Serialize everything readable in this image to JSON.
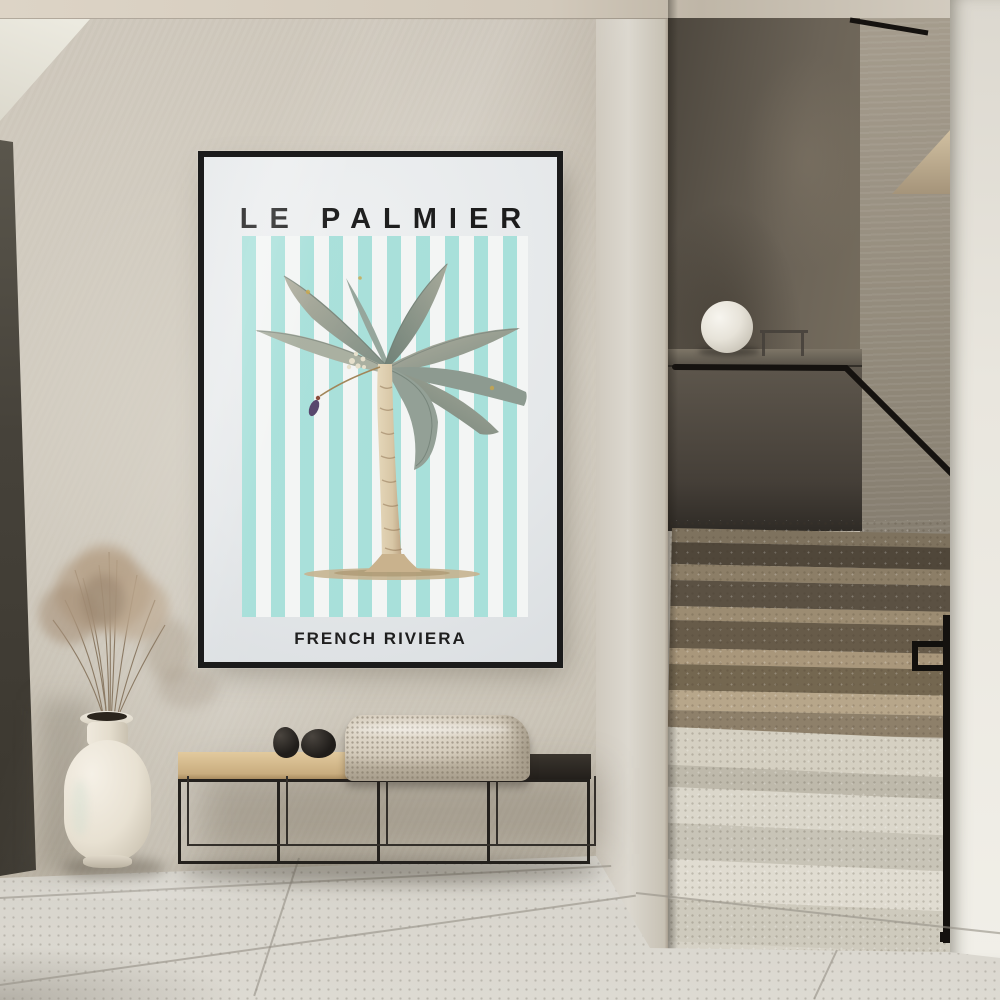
{
  "scene": {
    "setting": "minimalist hallway interior with terrazzo staircase and framed art print",
    "medium": "photograph"
  },
  "poster": {
    "title": "LE PALMIER",
    "subtitle": "FRENCH RIVIERA",
    "artwork": "banana palm botanical illustration on striped background",
    "stripe_color": "#a8e0da",
    "paper_color": "#e8eaeb",
    "frame_color": "#1b1b1b",
    "title_color": "#1c1c1c"
  },
  "objects": {
    "lamp": "white sphere table lamp on half-wall ledge",
    "handrail": "black metal handrail",
    "stairs": "terrazzo staircase, dark upper flight and light lower steps",
    "bench": "black metal frame bench, half wood / half black seat",
    "blanket": "cream knitted throw blanket",
    "stones": "two black decorative stones",
    "vase": "cream ceramic bottle vase",
    "plant": "dried pampas grass"
  },
  "palette": {
    "wall": "#c8c1b4",
    "ceiling": "#d6cdc0",
    "soffit": "#edebe1",
    "door_frame": "#46423a",
    "dark_stair_wall": "#5d564c",
    "stair_side_wall": "#8e8677",
    "right_wall": "#e9e6de",
    "upper_steps": "#9c8c72",
    "lower_steps": "#dbd7cb",
    "floor": "#d8d5cd",
    "bench_wood": "#d5bb91",
    "bench_metal": "#24211d",
    "blanket": "#d8d0c2",
    "stones": "#201d1a",
    "vase": "#efe9df",
    "grass": "#b29c83",
    "lamp": "#f1eee8",
    "handrail": "#15120f",
    "palm_leaf": "#8fa096",
    "palm_trunk": "#d8c7aa",
    "flower_bud": "#55446b"
  }
}
